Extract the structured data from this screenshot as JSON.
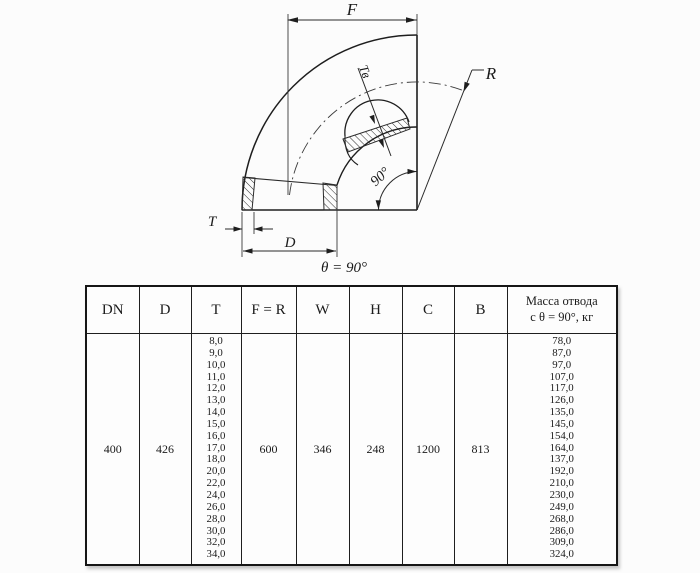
{
  "diagram": {
    "caption": "θ = 90°",
    "labels": {
      "f": "F",
      "r": "R",
      "t": "T",
      "d": "D",
      "tv": "Tв",
      "angle90": "90°"
    }
  },
  "table": {
    "headers": [
      "DN",
      "D",
      "T",
      "F = R",
      "W",
      "H",
      "C",
      "B",
      "Масса отвода\nс θ =  90°, кг"
    ],
    "row": {
      "dn": "400",
      "d": "426",
      "t_values": [
        "8,0",
        "9,0",
        "10,0",
        "11,0",
        "12,0",
        "13,0",
        "14,0",
        "15,0",
        "16,0",
        "17,0",
        "18,0",
        "20,0",
        "22,0",
        "24,0",
        "26,0",
        "28,0",
        "30,0",
        "32,0",
        "34,0"
      ],
      "f_r": "600",
      "w": "346",
      "h": "248",
      "c": "1200",
      "b": "813",
      "mass_values": [
        "78,0",
        "87,0",
        "97,0",
        "107,0",
        "117,0",
        "126,0",
        "135,0",
        "145,0",
        "154,0",
        "164,0",
        "137,0",
        "192,0",
        "210,0",
        "230,0",
        "249,0",
        "268,0",
        "286,0",
        "309,0",
        "324,0"
      ]
    }
  }
}
